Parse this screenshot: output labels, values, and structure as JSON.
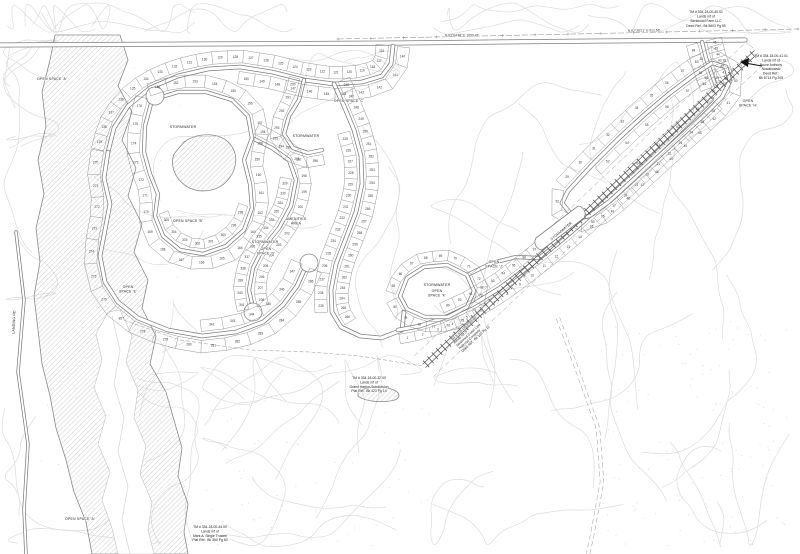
{
  "map": {
    "type": "subdivision-plat-map",
    "colors": {
      "paper": "#ffffff",
      "contour": "#dcdcdc",
      "linework": "#7d7d7d",
      "hatch": "#adadad",
      "text": "#222222"
    }
  },
  "area_labels": [
    {
      "id": "os-a-top",
      "text": "OPEN SPACE 'A'"
    },
    {
      "id": "os-a-bottom",
      "text": "OPEN SPACE 'A'"
    },
    {
      "id": "os-b",
      "text": "OPEN SPACE 'B'"
    },
    {
      "id": "os-c",
      "text": "OPEN SPACE 'C'"
    },
    {
      "id": "os-d",
      "lines": [
        "OPEN",
        "SPACE 'D'"
      ]
    },
    {
      "id": "os-e",
      "lines": [
        "OPEN",
        "SPACE 'E'"
      ]
    },
    {
      "id": "os-h",
      "lines": [
        "OPEN",
        "SPACE 'H'"
      ]
    },
    {
      "id": "os-j",
      "lines": [
        "OPEN",
        "SPACE 'J'"
      ]
    },
    {
      "id": "os-k",
      "lines": [
        "OPEN",
        "SPACE 'K'"
      ]
    },
    {
      "id": "sw-pond-west",
      "text": "STORMWATER"
    },
    {
      "id": "sw-upper-mid",
      "text": "STORMWATER"
    },
    {
      "id": "sw-center",
      "text": "STORMWATER"
    },
    {
      "id": "sw-east-oval",
      "text": "STORMWATER"
    },
    {
      "id": "sw-east-strip",
      "text": "STORMWATER"
    },
    {
      "id": "amenities",
      "lines": [
        "AMENITIES",
        "AREA"
      ]
    },
    {
      "id": "landing-rd",
      "text": "LANDING RD"
    }
  ],
  "parcel_notes": [
    {
      "id": "bentwood",
      "lines": [
        "TM # 334-18-00-40.01",
        "Lands n/f of",
        "Bentwood Farm LLC",
        "Deed Ref.: Bk 5603 Pg 99"
      ]
    },
    {
      "id": "nowakowski",
      "lines": [
        "TM # 334-18-00-41.01",
        "Lands n/f of",
        "Bruce Anthony",
        "Nowakowski",
        "Deed Ref.:",
        "Bk 5714 Pg 205"
      ]
    },
    {
      "id": "railroad",
      "lines": [
        "TM # 334-18-00-42.00",
        "Lands n/f of",
        "Seaboard Coast Line",
        "Railroad Company",
        "Deed Ref.: Bk 102 Pg 11"
      ]
    },
    {
      "id": "grand-harbor",
      "lines": [
        "TM # 334-18-00-32.00",
        "Lands n/f of",
        "Grand Harbor Subdivision",
        "Plat Ref.: Bk 423 Pg 14"
      ]
    },
    {
      "id": "single-trustee",
      "lines": [
        "TM # 334-18-00-44.00",
        "Lands n/f of",
        "Mark A. Single Trustee",
        "Plat Ref.: Bk 350 Pg 60"
      ]
    }
  ],
  "bearings": [
    {
      "id": "b1",
      "text": "N 63°04'48\" E   1059.43'"
    },
    {
      "id": "b2",
      "text": "N 62°39'21\" E   612.58'"
    }
  ],
  "lot_blocks": {
    "s1": {
      "start": 116,
      "count": 24
    },
    "s2": {
      "start": 140,
      "count": 11
    },
    "s3": {
      "start": 270,
      "count": 17
    },
    "s4": {
      "start": 342,
      "count": 6
    },
    "s5": {
      "start": 246,
      "count": 21
    },
    "s6": {
      "start": 225,
      "count": 15
    },
    "s7": {
      "start": 151,
      "count": 26
    },
    "s8": {
      "start": 298,
      "count": 8
    },
    "s9": {
      "start": 194,
      "count": 15
    },
    "s10": {
      "start": 329,
      "count": 13
    },
    "s11": {
      "start": 290,
      "count": 7
    },
    "e1": {
      "start": 1,
      "count": 26
    },
    "e2": {
      "start": 89,
      "count": 10
    },
    "e3": {
      "start": 29,
      "count": 24
    },
    "e4": {
      "start": 53,
      "count": 12
    },
    "e5": {
      "start": 65,
      "count": 16
    },
    "e6": {
      "start": 81,
      "count": 4
    },
    "e7": {
      "start": 40,
      "count": 7
    }
  }
}
